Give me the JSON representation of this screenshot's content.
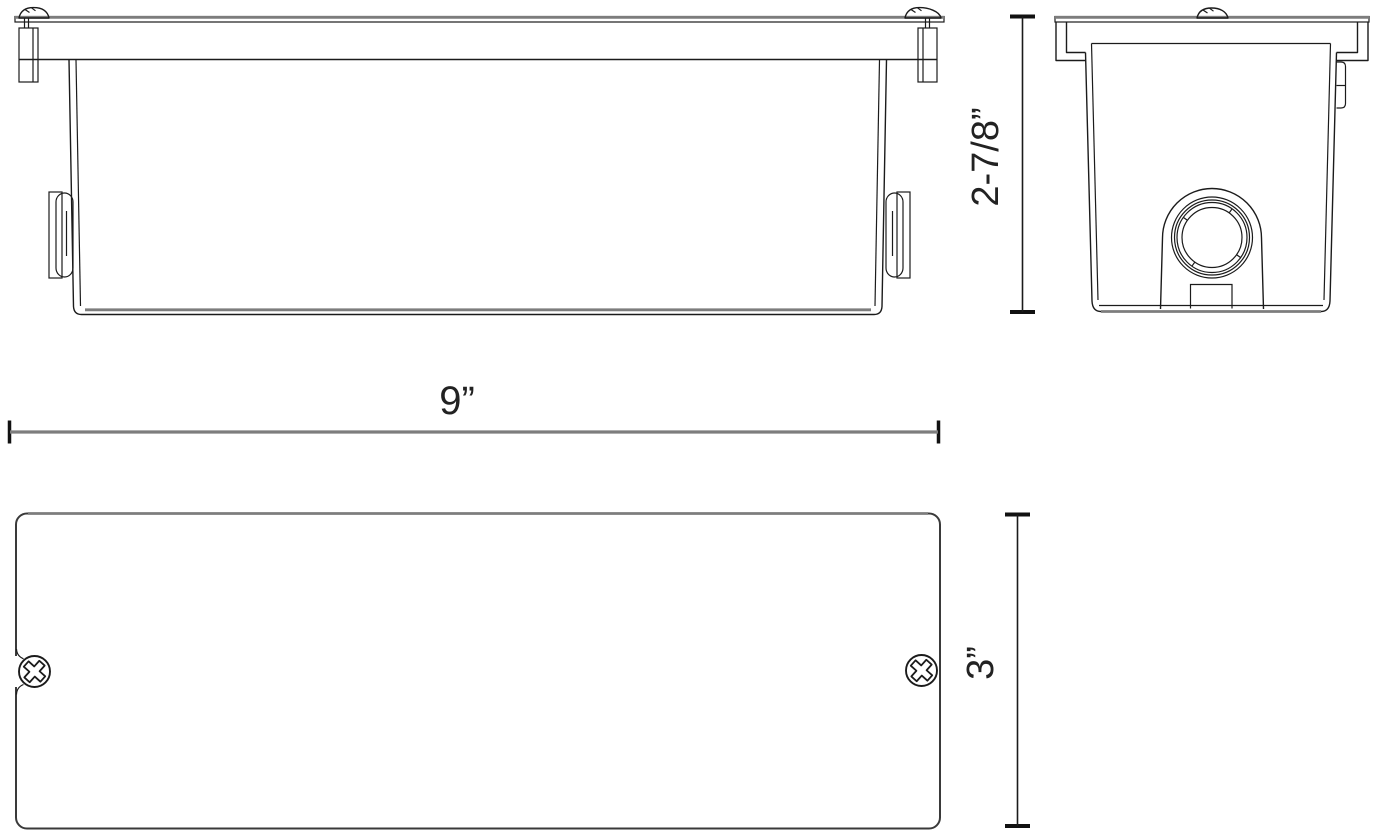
{
  "drawing": {
    "kind": "dimensioned technical drawing, three orthographic views of a recessed box fixture"
  },
  "dimensions": {
    "width": {
      "label": "9”"
    },
    "height": {
      "label": "2-7/8”"
    },
    "depth": {
      "label": "3”"
    }
  },
  "colors": {
    "primary_line": "#1b1b1b",
    "secondary_line": "#7d7d7d",
    "label_text": "#222222",
    "background": "#ffffff"
  }
}
